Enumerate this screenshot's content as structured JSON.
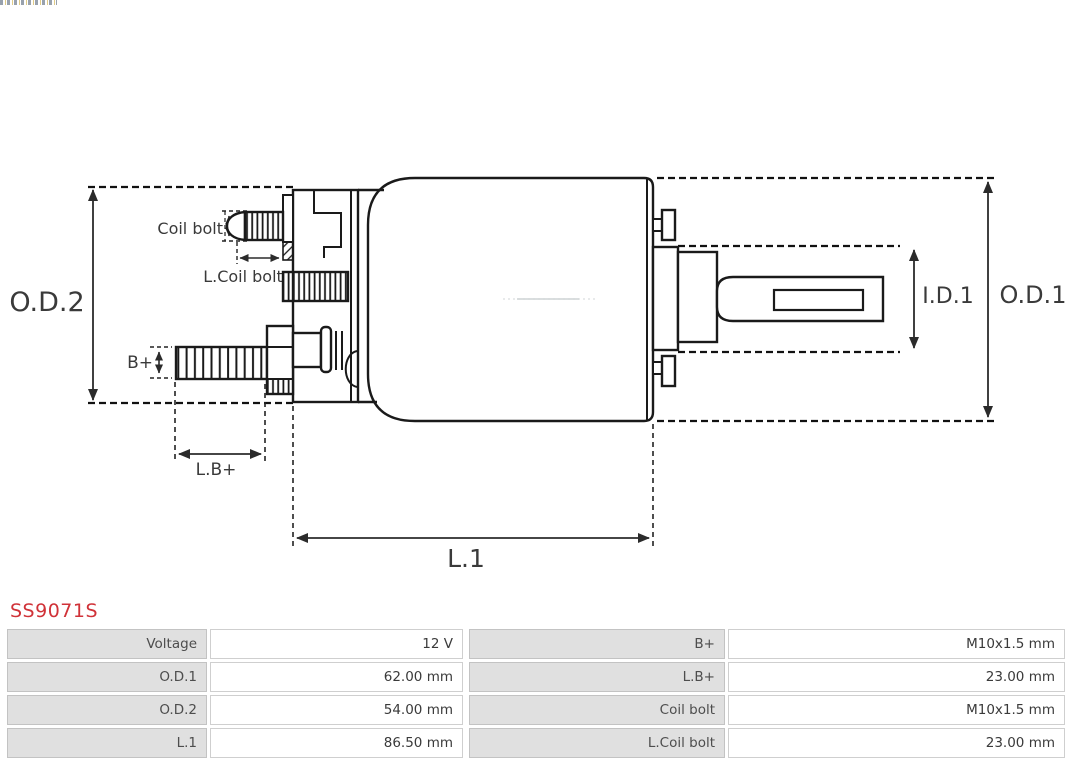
{
  "part": {
    "number": "SS9071S",
    "color": "#d03238"
  },
  "diagram": {
    "line_color": "#1a1a1a",
    "dimension_color": "#2b2b2b",
    "labels": {
      "od2": "O.D.2",
      "coil_bolt": "Coil bolt",
      "l_coil_bolt": "L.Coil bolt",
      "b_plus": "B+",
      "l_b_plus": "L.B+",
      "l1": "L.1",
      "id1": "I.D.1",
      "od1": "O.D.1"
    }
  },
  "table": {
    "label_bg": "#e0e0e0",
    "value_bg": "#ffffff",
    "rows": [
      {
        "cells": [
          {
            "label": "Voltage",
            "value": "12 V"
          },
          {
            "label": "B+",
            "value": "M10x1.5 mm"
          }
        ]
      },
      {
        "cells": [
          {
            "label": "O.D.1",
            "value": "62.00 mm"
          },
          {
            "label": "L.B+",
            "value": "23.00 mm"
          }
        ]
      },
      {
        "cells": [
          {
            "label": "O.D.2",
            "value": "54.00 mm"
          },
          {
            "label": "Coil bolt",
            "value": "M10x1.5 mm"
          }
        ]
      },
      {
        "cells": [
          {
            "label": "L.1",
            "value": "86.50 mm"
          },
          {
            "label": "L.Coil bolt",
            "value": "23.00 mm"
          }
        ]
      }
    ]
  }
}
